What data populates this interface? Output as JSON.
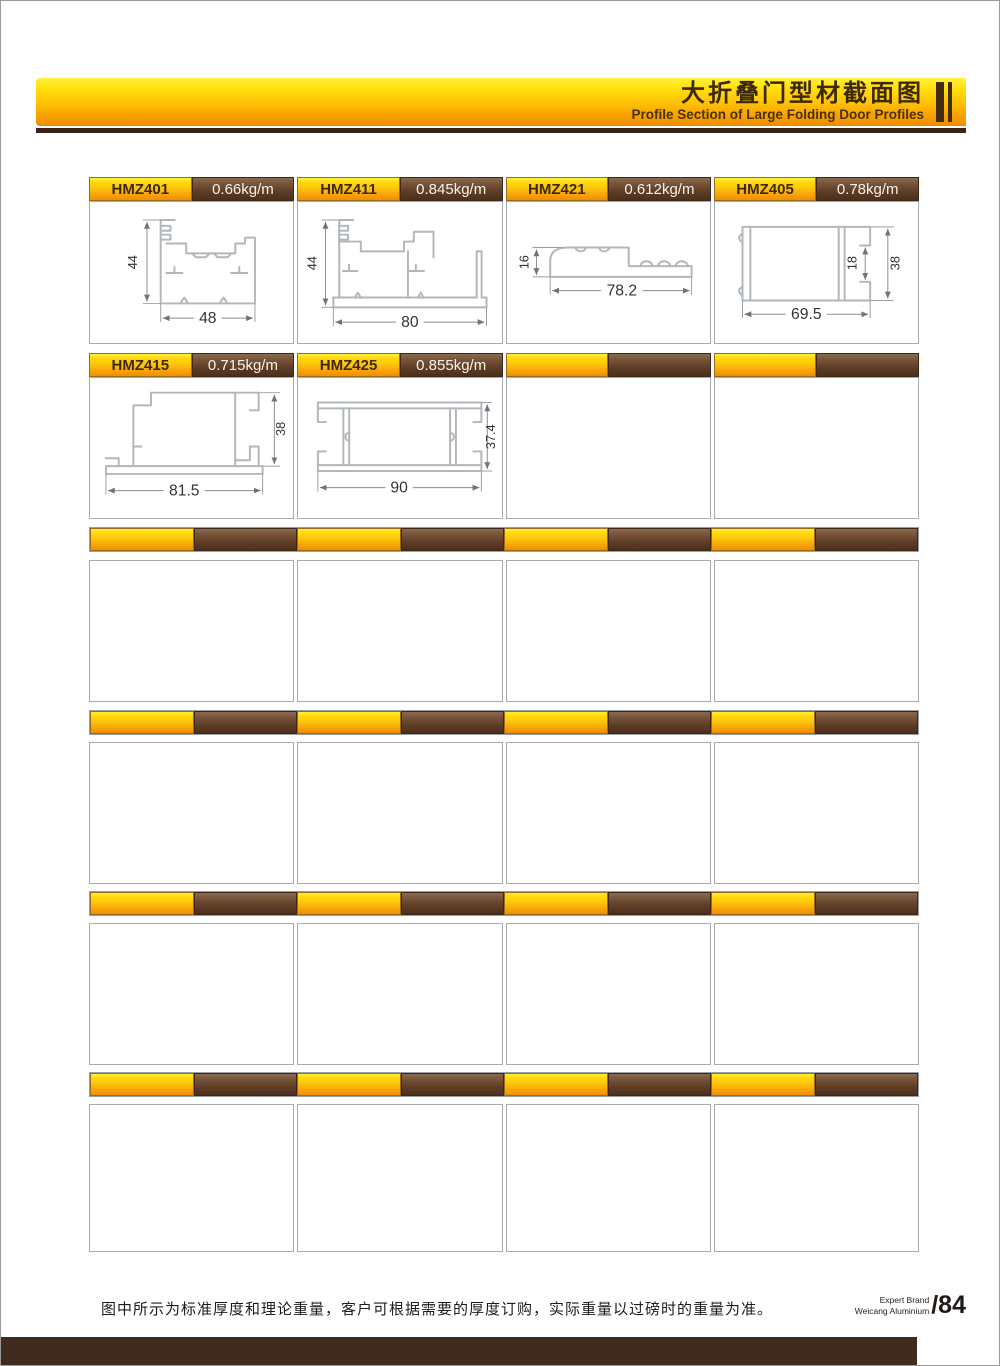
{
  "header": {
    "title_zh": "大折叠门型材截面图",
    "title_en": "Profile Section of Large Folding Door Profiles"
  },
  "profiles": [
    {
      "code": "HMZ401",
      "weight": "0.66kg/m",
      "dims": {
        "h": "44",
        "w": "48"
      }
    },
    {
      "code": "HMZ411",
      "weight": "0.845kg/m",
      "dims": {
        "h": "44",
        "w": "80"
      }
    },
    {
      "code": "HMZ421",
      "weight": "0.612kg/m",
      "dims": {
        "h": "16",
        "w": "78.2"
      }
    },
    {
      "code": "HMZ405",
      "weight": "0.78kg/m",
      "dims": {
        "h": "38",
        "w": "69.5",
        "slot": "18"
      }
    },
    {
      "code": "HMZ415",
      "weight": "0.715kg/m",
      "dims": {
        "h": "38",
        "w": "81.5"
      }
    },
    {
      "code": "HMZ425",
      "weight": "0.855kg/m",
      "dims": {
        "h": "37.4",
        "w": "90"
      }
    }
  ],
  "footer": {
    "note": "图中所示为标准厚度和理论重量，客户可根据需要的厚度订购，实际重量以过磅时的重量为准。",
    "brand_line1": "Expert Brand",
    "brand_line2": "Weicang Aluminium",
    "page_number": "/84"
  },
  "colors": {
    "band_yellow_top": "#fff23c",
    "band_orange_bottom": "#ee8c00",
    "segment_yellow": "#fdc30d",
    "segment_brown": "#5a3a24",
    "underline_brown": "#3a2418",
    "bottom_bar": "#3f2b20",
    "cell_border": "#a6abb0",
    "drawing_line": "#b2b7bb"
  }
}
